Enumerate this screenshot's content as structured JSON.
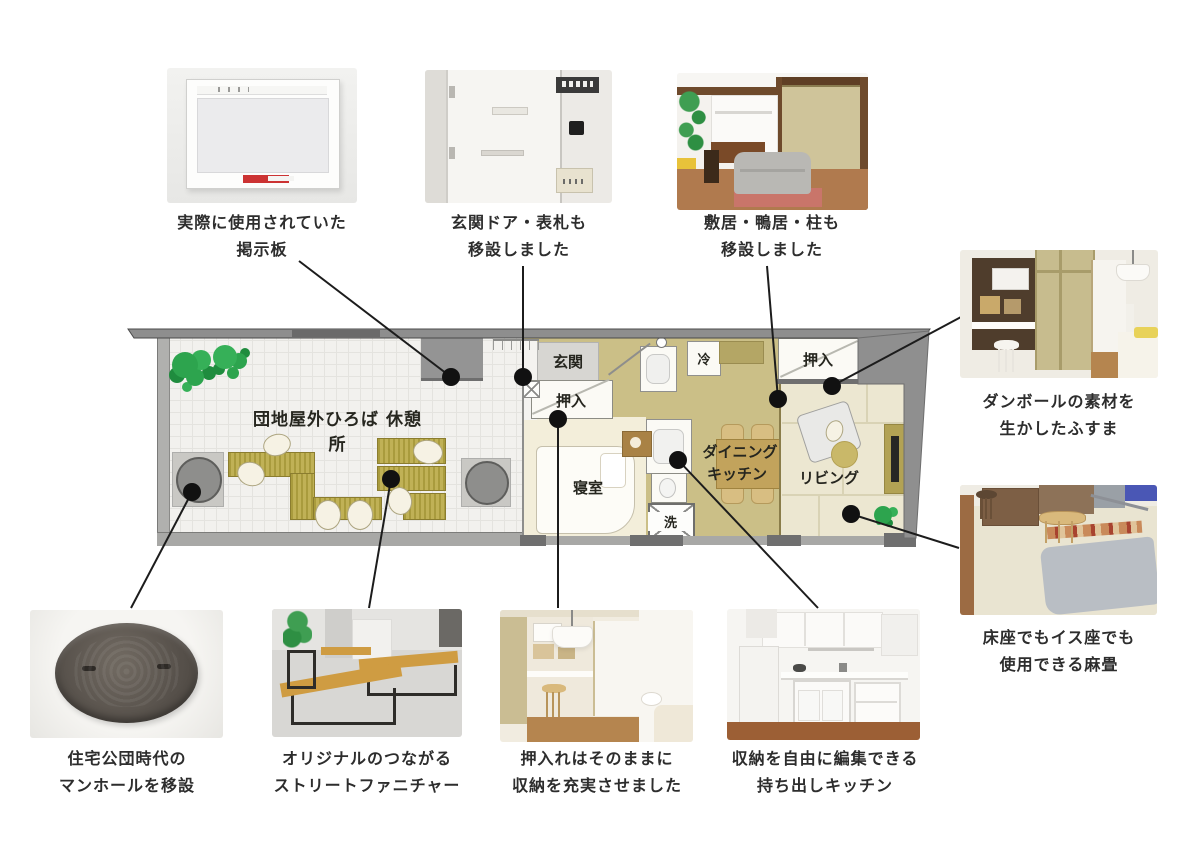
{
  "captions": {
    "bulletin_board": {
      "line1": "実際に使用されていた",
      "line2": "掲示板"
    },
    "entrance_door": {
      "line1": "玄関ドア・表札も",
      "line2": "移設しました"
    },
    "lintel_pillar": {
      "line1": "敷居・鴨居・柱も",
      "line2": "移設しました"
    },
    "cardboard_fusuma": {
      "line1": "ダンボールの素材を",
      "line2": "生かしたふすま"
    },
    "hemp_tatami": {
      "line1": "床座でもイス座でも",
      "line2": "使用できる麻畳"
    },
    "manhole": {
      "line1": "住宅公団時代の",
      "line2": "マンホールを移設"
    },
    "street_furniture": {
      "line1": "オリジナルのつながる",
      "line2": "ストリートファニチャー"
    },
    "oshiire_storage": {
      "line1": "押入れはそのままに",
      "line2": "収納を充実させました"
    },
    "portable_kitchen": {
      "line1": "収納を自由に編集できる",
      "line2": "持ち出しキッチン"
    }
  },
  "floorplan": {
    "plaza_label": "団地屋外ひろば 休憩所",
    "rooms": {
      "genkan": "玄関",
      "oshiire": "押入",
      "bedroom": "寝室",
      "fridge": "冷",
      "washer": "洗",
      "dining_line1": "ダイニング",
      "dining_line2": "キッチン",
      "living": "リビング"
    }
  },
  "colors": {
    "wall_gray": "#8f8f8f",
    "bench_olive": "#b3a343",
    "kitchen_floor": "#cbbf87",
    "bedroom_floor": "#f3eeda",
    "tatami_living": "#ece7d1",
    "tree_green": "#2da44e",
    "notice_red": "#cc3333",
    "connector_black": "#1c1c1c"
  }
}
